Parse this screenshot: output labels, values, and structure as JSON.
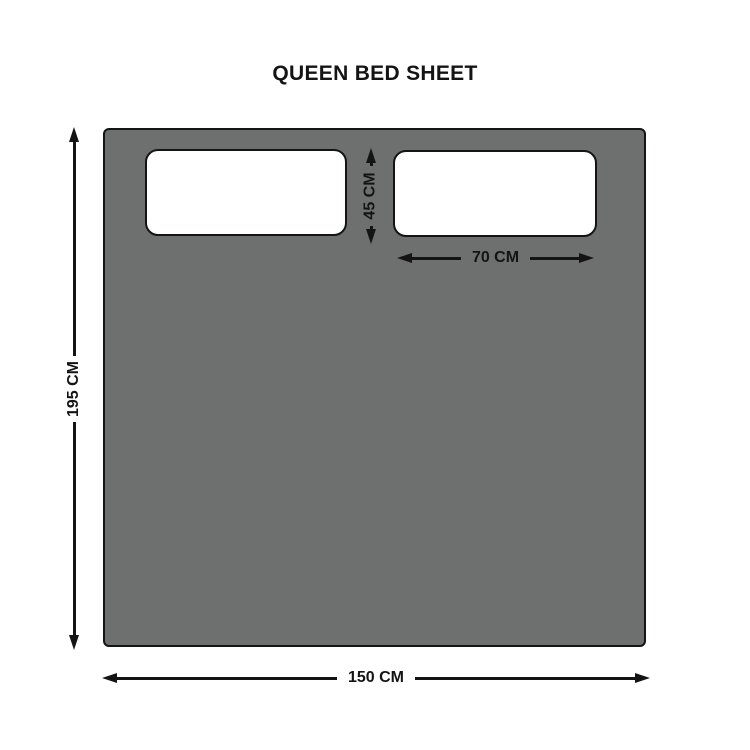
{
  "title": "QUEEN BED SHEET",
  "labels": {
    "sheet_height": "195 CM",
    "sheet_width": "150 CM",
    "pillow_height": "45 CM",
    "pillow_width": "70 CM"
  },
  "colors": {
    "sheet_fill": "#6e706f",
    "pillow_fill": "#ffffff",
    "outline": "#141414",
    "text": "#141414",
    "background": "#ffffff"
  }
}
